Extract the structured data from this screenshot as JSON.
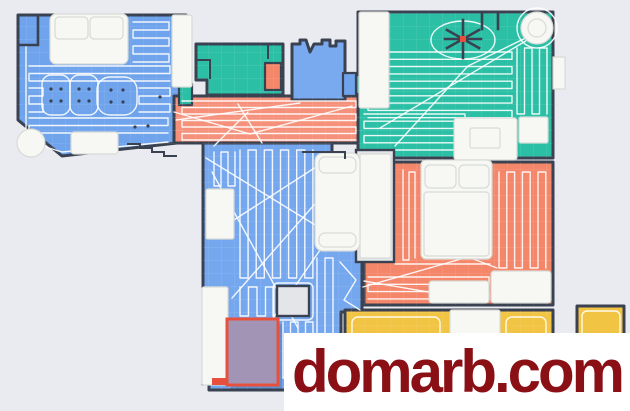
{
  "watermark": {
    "text": "domarb.com",
    "text_color": "#8A1016",
    "background": "#FFFFFF"
  },
  "map": {
    "palette": {
      "bg": "#E9EBF1",
      "wall": "#3A4150",
      "path": "#FFFFFF",
      "furn": "#F7F8F4",
      "furnstroke": "#D8DAD6",
      "niche": "#E3E5E8",
      "red": "#E8503E",
      "wmred": "#8A1016",
      "wmbg": "#FFFFFF"
    },
    "rooms": [
      {
        "id": "living-room",
        "color": "#6FA3EC"
      },
      {
        "id": "hallway",
        "color": "#F5907A"
      },
      {
        "id": "bathroom",
        "color": "#2BBFA6"
      },
      {
        "id": "toilet",
        "color": "#79A9EE"
      },
      {
        "id": "bedroom-top-right",
        "color": "#2BBFA6"
      },
      {
        "id": "bedroom-right",
        "color": "#F4866A"
      },
      {
        "id": "middle-room",
        "color": "#74A7EE"
      },
      {
        "id": "kitchen",
        "color": "#F2C443"
      },
      {
        "id": "balcony",
        "color": "#F2C443"
      },
      {
        "id": "no-go-zone",
        "color": "#A294B4"
      }
    ],
    "icons": {
      "ceiling_fan": "asterisk-shape",
      "dock": "circle-shape"
    }
  }
}
